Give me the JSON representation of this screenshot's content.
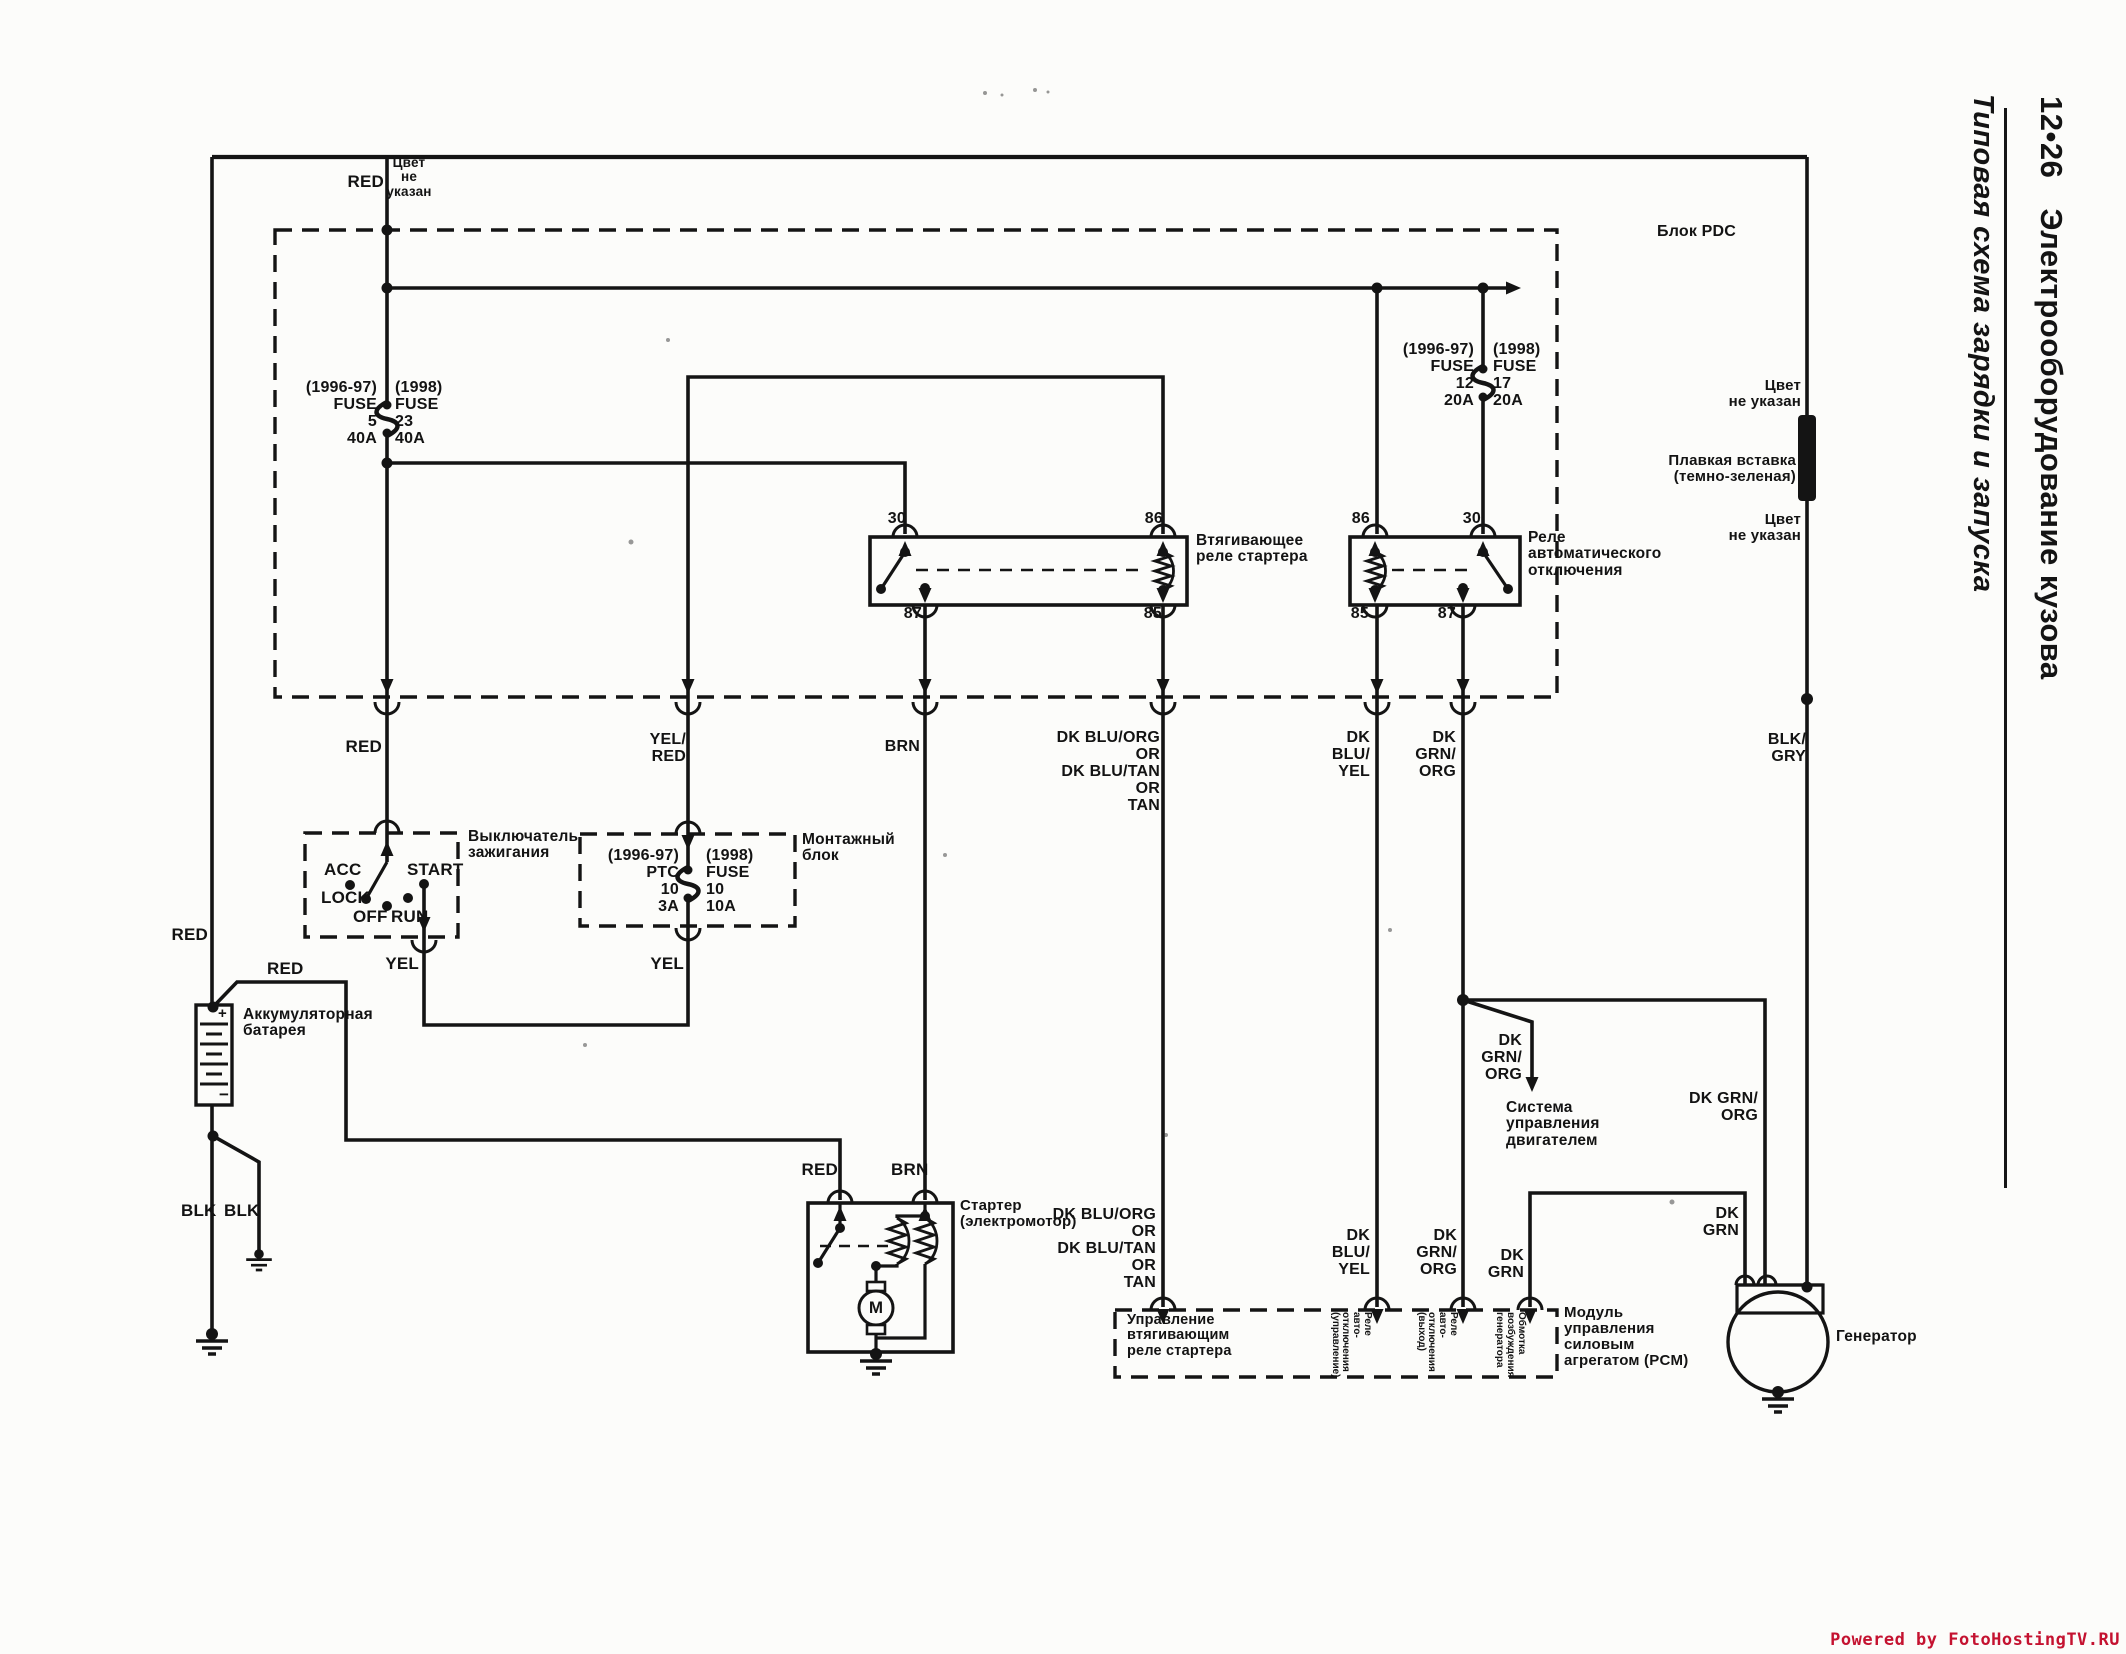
{
  "header": {
    "page_number": "12•26",
    "title": "Электрооборудование кузова",
    "subtitle": "Типовая схема зарядки и запуска"
  },
  "footer": {
    "text": "Powered by FotoHostingTV.RU",
    "color": "#c41230"
  },
  "pdc": {
    "label": "Блок PDC",
    "fuse_main_left": "(1996-97)\nFUSE\n5\n40A",
    "fuse_main_right": "(1998)\nFUSE\n23\n40A",
    "fuse_asd_left": "(1996-97)\nFUSE\n12\n20A",
    "fuse_asd_right": "(1998)\nFUSE\n17\n20A"
  },
  "relays": {
    "starter_relay_label": "Втягивающее\nреле стартера",
    "asd_relay_label": "Реле\nавтоматического\nотключения",
    "starter_relay_pins": {
      "p30": "30",
      "p86": "86",
      "p87": "87",
      "p85": "85"
    },
    "asd_relay_pins": {
      "p86": "86",
      "p30": "30",
      "p85": "85",
      "p87": "87"
    }
  },
  "ignition": {
    "label": "Выключатель\nзажигания",
    "positions": {
      "acc": "ACC",
      "lock": "LOCK",
      "off": "OFF",
      "run": "RUN",
      "start": "START"
    }
  },
  "mounting_block": {
    "label": "Монтажный\nблок",
    "fuse_left": "(1996-97)\nPTC\n10\n3A",
    "fuse_right": "(1998)\nFUSE\n10\n10A"
  },
  "battery": {
    "label": "Аккумуляторная\nбатарея",
    "plus": "+",
    "minus": "−"
  },
  "starter": {
    "label": "Стартер\n(электромотор)",
    "motor_symbol": "M",
    "red": "RED",
    "brn": "BRN"
  },
  "pcm": {
    "label": "Модуль\nуправления\nсиловым\nагрегатом (PCM)",
    "in_starter_relay": "Управление\nвтягивающим\nреле стартера",
    "in_asd_control": "Реле\nавто-\nотключения\n(управление)",
    "in_asd_output": "Реле\nавто-\nотключения\n(выход)",
    "in_gen_field": "Обмотка\nвозбуждения\nгенератора"
  },
  "generator": {
    "label": "Генератор"
  },
  "engine_mgmt": {
    "label": "Система\nуправления\nдвигателем"
  },
  "right_bus": {
    "color_na_top": "Цвет\nне указан",
    "fusible_link": "Плавкая вставка\n(темно-зеленая)",
    "color_na_bottom": "Цвет\nне указан",
    "blk_gry": "BLK/\nGRY"
  },
  "wire_labels": {
    "red_top": "RED",
    "color_na": "Цвет\nне\nуказан",
    "red_feed": "RED",
    "red_left": "RED",
    "red_battery": "RED",
    "yel_red": "YEL/\nRED",
    "yel_start": "YEL",
    "yel_block": "YEL",
    "brn_pdc": "BRN",
    "dk_blu_group1": "DK BLU/ORG\nOR\nDK BLU/TAN\nOR\nTAN",
    "dk_blu_group2": "DK BLU/ORG\nOR\nDK BLU/TAN\nOR\nTAN",
    "dk_blu_yel1": "DK\nBLU/\nYEL",
    "dk_blu_yel2": "DK\nBLU/\nYEL",
    "dk_grn_org1": "DK\nGRN/\nORG",
    "dk_grn_org2": "DK\nGRN/\nORG",
    "dk_grn_org3": "DK\nGRN/\nORG",
    "dk_grn_org4": "DK GRN/\nORG",
    "dk_grn1": "DK\nGRN",
    "dk_grn2": "DK\nGRN",
    "blk1": "BLK",
    "blk2": "BLK"
  }
}
